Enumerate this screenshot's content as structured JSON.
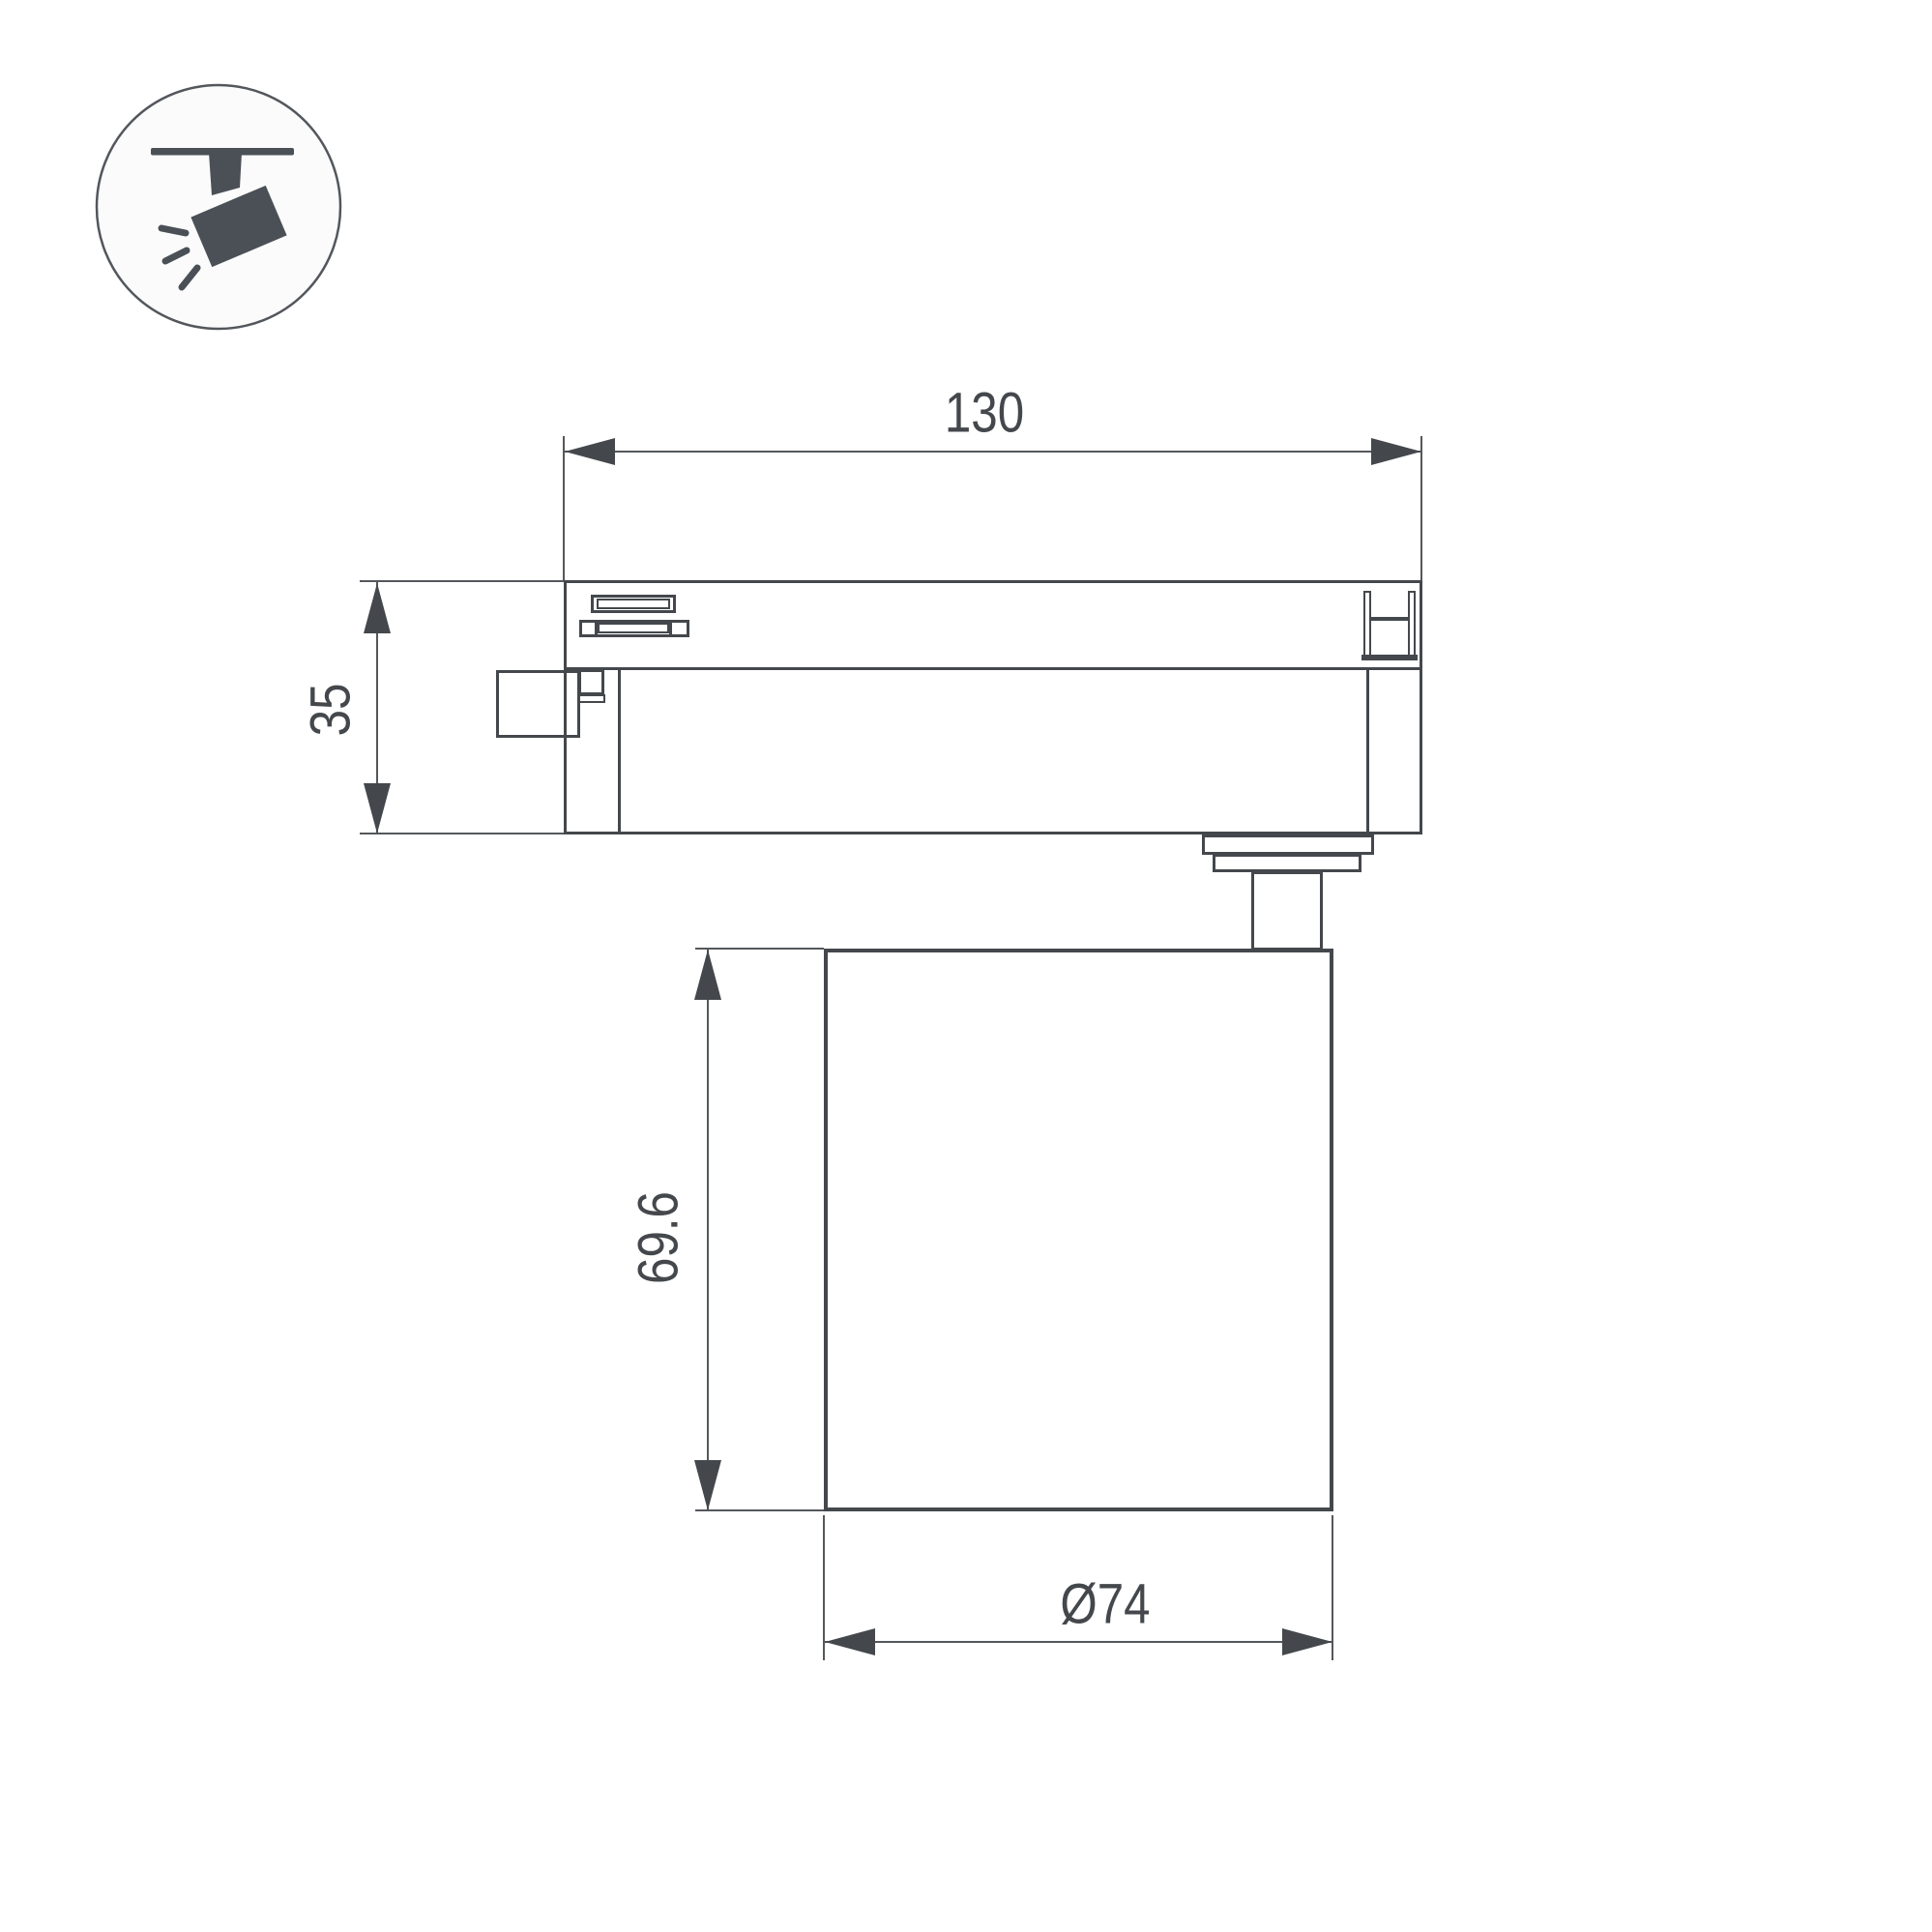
{
  "drawing": {
    "kind": "luminaire-technical-drawing",
    "colors": {
      "line": "#44484c",
      "thin_line": "#54585c",
      "icon_fill": "#4a5056",
      "background": "#ffffff",
      "icon_circle_fill": "#fbfbfc"
    },
    "icon": {
      "name": "track-spotlight-icon"
    },
    "dims": {
      "track_width": "130",
      "track_height": "35",
      "head_height": "69.6",
      "head_diameter": "Ø74"
    }
  }
}
